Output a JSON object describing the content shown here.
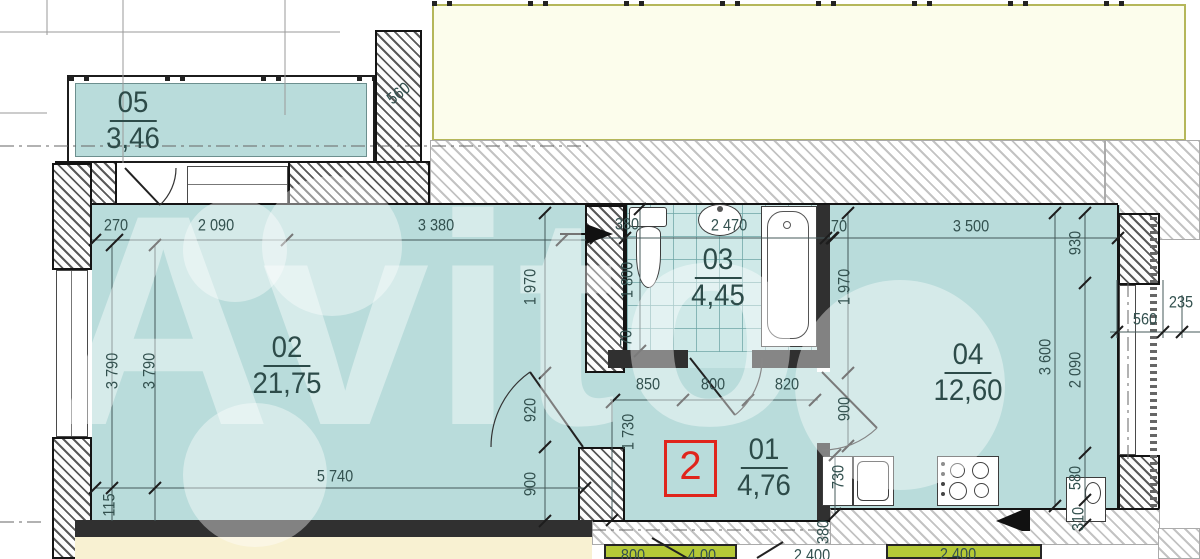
{
  "plan": {
    "watermark": "Avito",
    "unit_marker": "2",
    "rooms": [
      {
        "num": "05",
        "area": "3,46",
        "cx": 133,
        "cy": 121
      },
      {
        "num": "02",
        "area": "21,75",
        "cx": 287,
        "cy": 366
      },
      {
        "num": "03",
        "area": "4,45",
        "cx": 718,
        "cy": 278
      },
      {
        "num": "01",
        "area": "4,76",
        "cx": 764,
        "cy": 468
      },
      {
        "num": "04",
        "area": "12,60",
        "cx": 968,
        "cy": 373
      }
    ],
    "dims": [
      {
        "t": "270",
        "x": 116,
        "y": 226,
        "o": "h"
      },
      {
        "t": "2 090",
        "x": 216,
        "y": 226,
        "o": "h"
      },
      {
        "t": "3 380",
        "x": 436,
        "y": 226,
        "o": "h"
      },
      {
        "t": "380",
        "x": 627,
        "y": 225,
        "o": "h"
      },
      {
        "t": "2 470",
        "x": 729,
        "y": 226,
        "o": "h"
      },
      {
        "t": "70",
        "x": 839,
        "y": 227,
        "o": "h"
      },
      {
        "t": "3 500",
        "x": 971,
        "y": 227,
        "o": "h"
      },
      {
        "t": "850",
        "x": 648,
        "y": 385,
        "o": "h"
      },
      {
        "t": "800",
        "x": 713,
        "y": 385,
        "o": "h"
      },
      {
        "t": "820",
        "x": 787,
        "y": 385,
        "o": "h"
      },
      {
        "t": "5 740",
        "x": 335,
        "y": 477,
        "o": "h"
      },
      {
        "t": "560",
        "x": 1145,
        "y": 320,
        "o": "h"
      },
      {
        "t": "235",
        "x": 1181,
        "y": 303,
        "o": "h"
      },
      {
        "t": "800",
        "x": 633,
        "y": 556,
        "o": "h"
      },
      {
        "t": "4,00",
        "x": 702,
        "y": 556,
        "o": "h"
      },
      {
        "t": "2 400",
        "x": 812,
        "y": 556,
        "o": "h"
      },
      {
        "t": "2 400",
        "x": 958,
        "y": 555,
        "o": "h"
      },
      {
        "t": "3 790",
        "x": 113,
        "y": 371,
        "o": "v"
      },
      {
        "t": "3 790",
        "x": 150,
        "y": 371,
        "o": "v"
      },
      {
        "t": "115",
        "x": 110,
        "y": 505,
        "o": "v"
      },
      {
        "t": "1 970",
        "x": 531,
        "y": 287,
        "o": "v"
      },
      {
        "t": "920",
        "x": 531,
        "y": 410,
        "o": "v"
      },
      {
        "t": "900",
        "x": 531,
        "y": 484,
        "o": "v"
      },
      {
        "t": "1 800",
        "x": 628,
        "y": 280,
        "o": "v"
      },
      {
        "t": "70",
        "x": 627,
        "y": 338,
        "o": "v"
      },
      {
        "t": "1 730",
        "x": 629,
        "y": 432,
        "o": "v"
      },
      {
        "t": "1 970",
        "x": 845,
        "y": 287,
        "o": "v"
      },
      {
        "t": "900",
        "x": 845,
        "y": 409,
        "o": "v"
      },
      {
        "t": "730",
        "x": 839,
        "y": 477,
        "o": "v"
      },
      {
        "t": "380",
        "x": 824,
        "y": 532,
        "o": "v"
      },
      {
        "t": "930",
        "x": 1076,
        "y": 243,
        "o": "v"
      },
      {
        "t": "3 600",
        "x": 1046,
        "y": 357,
        "o": "v"
      },
      {
        "t": "2 090",
        "x": 1076,
        "y": 370,
        "o": "v"
      },
      {
        "t": "580",
        "x": 1076,
        "y": 478,
        "o": "v"
      },
      {
        "t": "310",
        "x": 1079,
        "y": 519,
        "o": "v"
      },
      {
        "t": "560",
        "x": 399,
        "y": 94,
        "o": "d"
      }
    ],
    "colors": {
      "room_fill": "#b9dcdb",
      "tile_fill": "#cfe9e8",
      "wall_line": "#141414",
      "dim_text": "#33514f",
      "marker_red": "#e0251c",
      "neighbor_yellow": "#fcfdec",
      "neighbor_green": "#b5c937",
      "watermark": "#ffffff"
    }
  }
}
